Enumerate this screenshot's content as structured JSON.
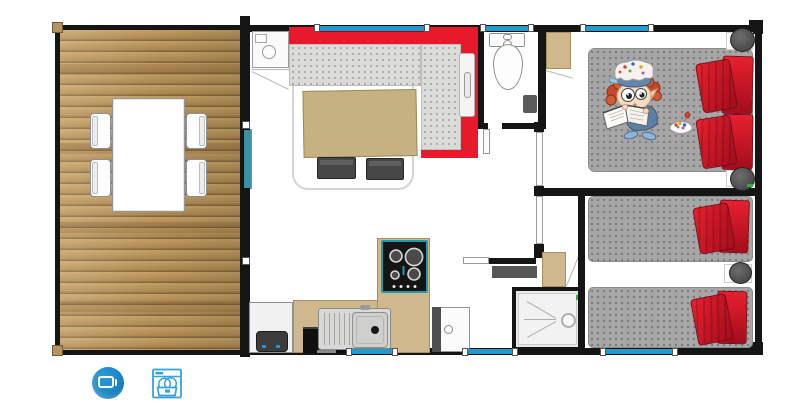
{
  "scene": {
    "kind": "mobile-home floor plan",
    "rooms": [
      "terrace",
      "living-room",
      "kitchen",
      "wc",
      "hallway",
      "shower-room",
      "master-bedroom",
      "twin-bedroom"
    ]
  },
  "colors": {
    "wall": "#151515",
    "window-blue": "#1f9ccd",
    "door-teal": "#3b91a4",
    "sofa-red": "#e8192b",
    "pillow-a": "#e8202f",
    "pillow-b": "#a30d1c",
    "seat-gray": "#dbdbd9",
    "bed-gray": "#a6a6a6",
    "furn-tan": "#cfb88d",
    "hob-teal": "#1e9aa8",
    "shelf-gray": "#565656",
    "icon-blue": "#1a85c8",
    "icon-stroke": "#35a3d9"
  },
  "terrace": {
    "table_count": 1,
    "chair_count": 4,
    "floor": "wood-planks"
  },
  "living_room": {
    "furniture": [
      "corner-sofa",
      "coffee-table",
      "stool",
      "stool",
      "refrigerator"
    ],
    "sofa_shape": "L"
  },
  "kitchen": {
    "appliances": [
      "gas-hob",
      "sink",
      "oven",
      "under-counter-appliance"
    ],
    "hob_burner_count": 4
  },
  "wc": {
    "fixtures": [
      "toilet",
      "waste-bin"
    ]
  },
  "shower_room": {
    "fixtures": [
      "shower-tray",
      "water-heater-cabinet",
      "shelf"
    ]
  },
  "master_bedroom": {
    "bed_type": "double",
    "pillow_count": 4,
    "nightstand_count": 2,
    "decor": "child-reading-book-illustration",
    "decor_extra": "candy-bowl"
  },
  "twin_bedroom": {
    "bed_count": 2,
    "bed_type": "single",
    "pillow_count": 4,
    "nightstand_count": 1
  },
  "storage": {
    "wardrobe_count": 2
  },
  "openings": {
    "top_windows": 3,
    "bottom_windows": 3,
    "patio_door": 1,
    "interior_doors": 4
  },
  "legend": {
    "icons": [
      {
        "name": "tv-icon"
      },
      {
        "name": "dishwasher-icon"
      }
    ]
  }
}
